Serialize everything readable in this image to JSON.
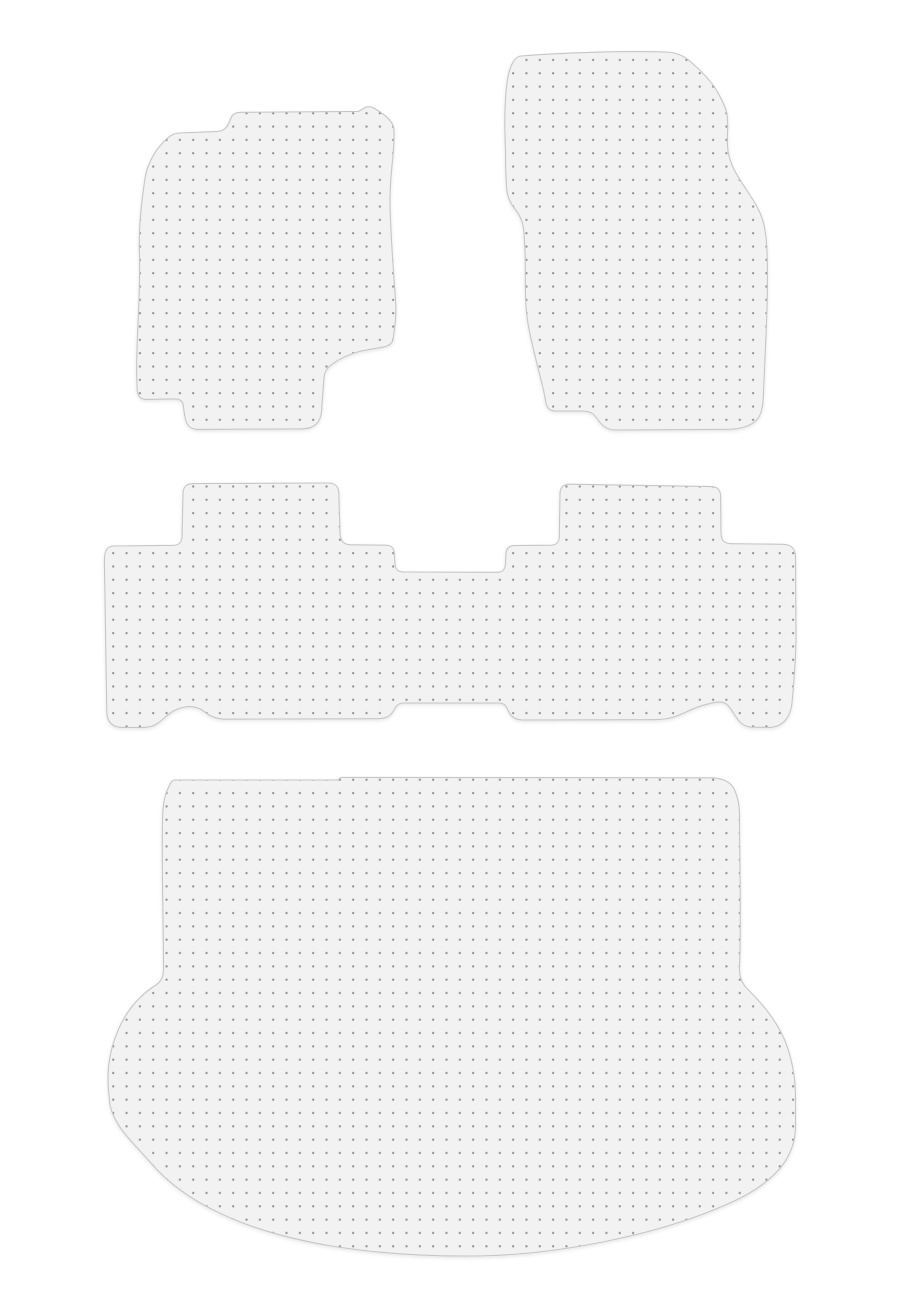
{
  "image": {
    "width_px": 900,
    "height_px": 1310,
    "background_color": "#ffffff"
  },
  "mat_style": {
    "fill_color": "#f2f2f2",
    "outline_color": "#c6c6c6",
    "dot_color": "#8d8d8d",
    "dot_spacing_px": 13.33,
    "dot_size_px": 2,
    "shadow_opacity": 0.1
  },
  "mats": [
    {
      "name": "front-left-floor-mat"
    },
    {
      "name": "front-right-floor-mat"
    },
    {
      "name": "rear-bench-floor-mat"
    },
    {
      "name": "cargo-area-mat"
    }
  ]
}
